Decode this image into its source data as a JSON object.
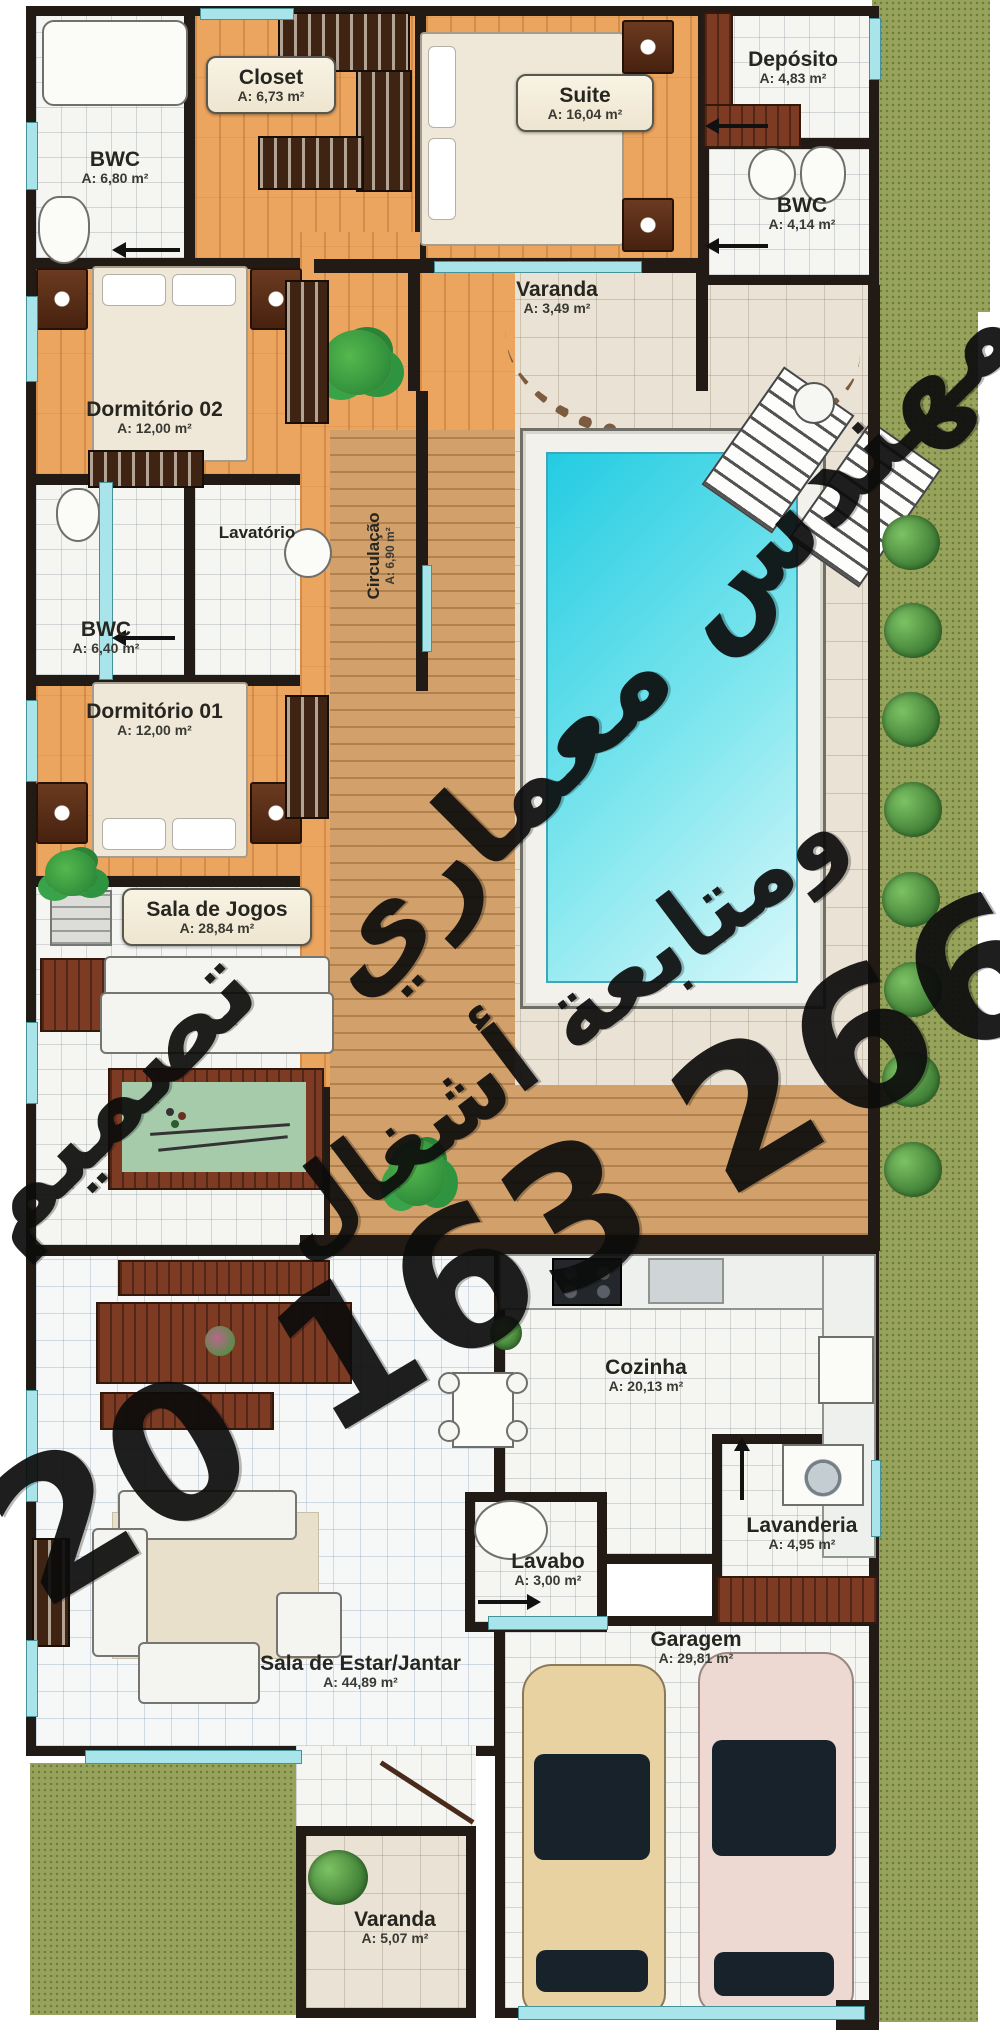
{
  "plan_title": "Residential floor plan (Portuguese labels)",
  "rooms": [
    {
      "id": "bwc-top",
      "name": "BWC",
      "area": "A: 6,80 m²"
    },
    {
      "id": "closet",
      "name": "Closet",
      "area": "A: 6,73 m²"
    },
    {
      "id": "suite",
      "name": "Suite",
      "area": "A: 16,04 m²"
    },
    {
      "id": "deposito",
      "name": "Depósito",
      "area": "A: 4,83 m²"
    },
    {
      "id": "bwc-right",
      "name": "BWC",
      "area": "A: 4,14 m²"
    },
    {
      "id": "varanda-top",
      "name": "Varanda",
      "area": "A: 3,49 m²"
    },
    {
      "id": "dormitorio-02",
      "name": "Dormitório 02",
      "area": "A: 12,00 m²"
    },
    {
      "id": "bwc-mid",
      "name": "BWC",
      "area": "A: 6,40 m²"
    },
    {
      "id": "lavatorio",
      "name": "Lavatório",
      "area": ""
    },
    {
      "id": "circulacao",
      "name": "Circulação",
      "area": "A: 6,90 m²"
    },
    {
      "id": "dormitorio-01",
      "name": "Dormitório 01",
      "area": "A: 12,00 m²"
    },
    {
      "id": "sala-de-jogos",
      "name": "Sala de Jogos",
      "area": "A: 28,84 m²"
    },
    {
      "id": "cozinha",
      "name": "Cozinha",
      "area": "A: 20,13 m²"
    },
    {
      "id": "lavabo",
      "name": "Lavabo",
      "area": "A: 3,00 m²"
    },
    {
      "id": "lavanderia",
      "name": "Lavanderia",
      "area": "A: 4,95 m²"
    },
    {
      "id": "sala-estar-jantar",
      "name": "Sala de Estar/Jantar",
      "area": "A: 44,89 m²"
    },
    {
      "id": "garagem",
      "name": "Garagem",
      "area": "A: 29,81 m²"
    },
    {
      "id": "varanda-bottom",
      "name": "Varanda",
      "area": "A: 5,07 m²"
    }
  ],
  "watermark": {
    "line1": "مهندس معماري",
    "line2": "تصميم",
    "line3": "ومتابعة أشغال",
    "phone": "20 163 266",
    "color": "#0c0c0c"
  },
  "palette": {
    "wall": "#221b15",
    "window_cyan": "#a9e4ea",
    "wood_floor": "#eca55f",
    "deck_wood": "#d2a06a",
    "grass": "#97a35b",
    "pool_water": "#23cce2",
    "billiard_felt": "#a6cbaa",
    "car_tan": "#e9d2a2",
    "car_pink": "#eed9d2"
  }
}
